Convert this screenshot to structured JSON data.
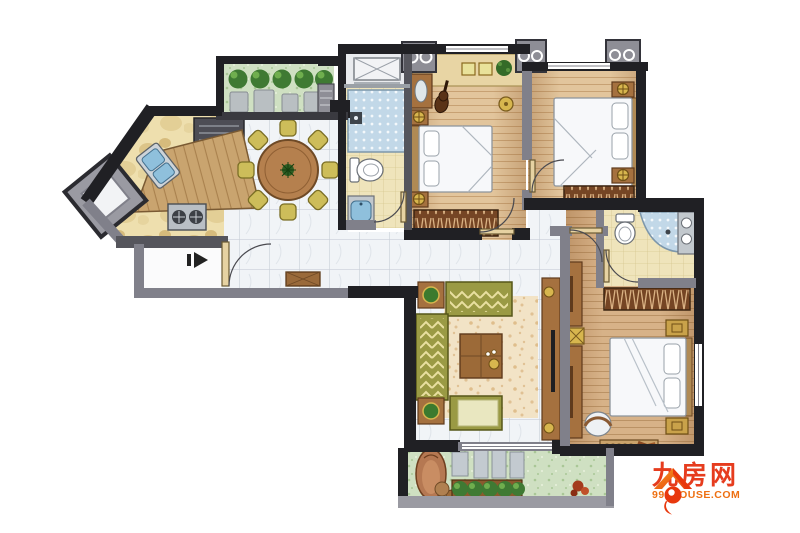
{
  "watermark": {
    "brand": "九房网",
    "domain": "999HOUSE.COM"
  },
  "colors": {
    "wall_dark": "#202024",
    "wall_gray": "#80808a",
    "wall_mid": "#55555c",
    "tile": "#f1f4f7",
    "tile_line": "#c9cfd8",
    "wood_floor": "#e2c59c",
    "wood_floor_line": "#c7a173",
    "wood_master": "#d7b288",
    "wood_master_line": "#ba9265",
    "kitchen_floor": "#eedfae",
    "kitchen_blob": "#dcc488",
    "bath_floor": "#efe4bb",
    "bath_line": "#d6c891",
    "shower_blue": "#c2d8e8",
    "basin_blue": "#8fc0dc",
    "counter": "#c9a46f",
    "furn_wood": "#a5713f",
    "furn_wood_dark": "#5f3a1c",
    "wardrobe_brown": "#754524",
    "wardrobe_line": "#d9b183",
    "gold": "#d7b64e",
    "gold_dark": "#7a5c1e",
    "olive": "#9a9a44",
    "olive_dark": "#565618",
    "cushion": "#e9e7c0",
    "rug": "#f2e3c6",
    "rug_dot": "#e0c194",
    "balcony_green": "#cfe0c2",
    "bush_green": "#3f7a33",
    "bush_light": "#6fae4e",
    "bed_white": "#f7f8fa",
    "bed_line": "#8d949c",
    "appliance_gray": "#c3cad0",
    "brand_red": "#e63c1e",
    "brand_orange": "#ee7012"
  }
}
